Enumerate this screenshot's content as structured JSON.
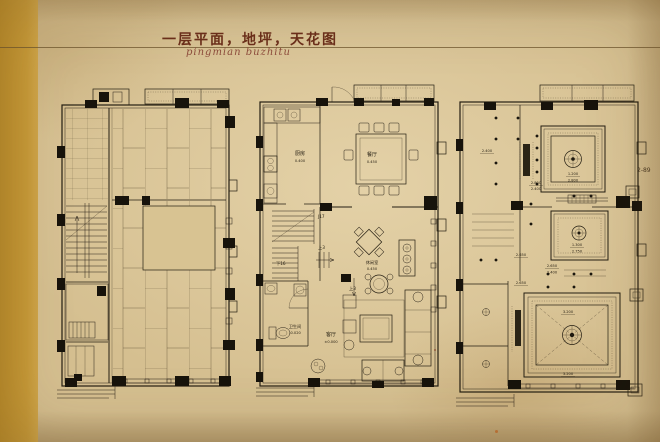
{
  "page": {
    "title": "一层平面，地坪，天花图",
    "subtitle": "pingmian buzhitu",
    "side_note": "2-89"
  },
  "colors": {
    "paper": "#d5bf90",
    "binding_band": "#c5973a",
    "ink": "#241e12",
    "title_red": "#6b2f1b"
  },
  "plans": {
    "left": "floor-paving-plan",
    "middle": "furniture-layout-plan",
    "right": "ceiling-plan"
  },
  "furniture_plan": {
    "rooms": {
      "kitchen": {
        "name": "厨房",
        "level": "0.400"
      },
      "dining": {
        "name": "餐厅",
        "level": "0.450"
      },
      "leisure": {
        "name": "休闲室",
        "level": "0.450"
      },
      "living": {
        "name": "客厅",
        "level": "±0.000"
      },
      "bath": {
        "name": "卫生间",
        "level": "-0.020"
      }
    },
    "stairs": {
      "ref": "J17",
      "down": "下16",
      "up_a": "上3",
      "up_b": "上3"
    }
  },
  "ceiling_plan": {
    "levels": {
      "corridor": "2.400",
      "k1": "2.800",
      "k2": "2.400",
      "dining_drop": "1.200",
      "dining_clg": "2.800",
      "tea_drop": "1.300",
      "tea_clg": "2.750",
      "hall_a": "2.650",
      "hall_b": "2.650",
      "hall_c": "2.400",
      "hall_d": "2.650",
      "living_clg": "3.200",
      "living_edge": "3.200"
    }
  }
}
